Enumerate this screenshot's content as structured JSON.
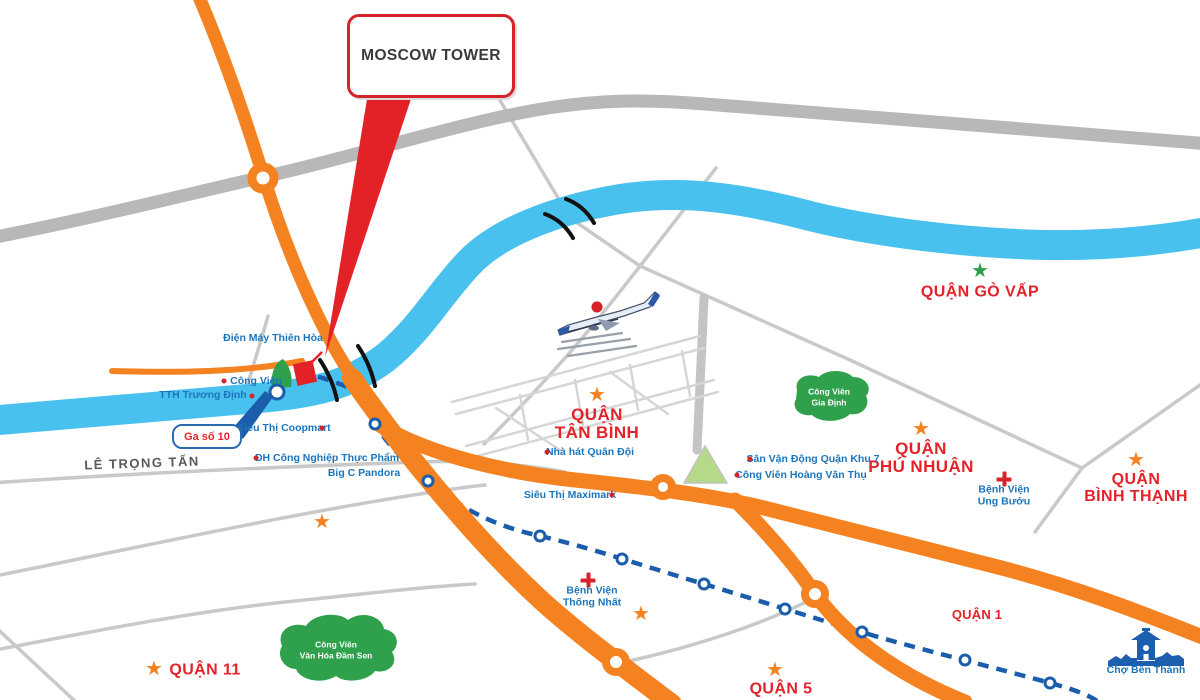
{
  "title_callout": {
    "label": "MOSCOW TOWER"
  },
  "station_callout": {
    "label": "Ga số 10"
  },
  "street": {
    "label": "LÊ TRỌNG TẤN"
  },
  "colors": {
    "road_orange": "#F58220",
    "river_blue": "#49C1EF",
    "metro_blue": "#1A5DAB",
    "label_blue": "#1B75BC",
    "accent_red": "#E4222A",
    "park_green": "#2FA04C",
    "road_gray": "#B8B8B8",
    "star_green": "#2E9E4A"
  },
  "districts": [
    {
      "id": "go-vap",
      "lines": [
        "QUẬN GÒ VẤP"
      ],
      "x": 980,
      "y": 293,
      "font": 16
    },
    {
      "id": "tan-binh",
      "lines": [
        "QUẬN",
        "TÂN BÌNH"
      ],
      "x": 597,
      "y": 424,
      "font": 17
    },
    {
      "id": "phu-nhuan",
      "lines": [
        "QUẬN",
        "PHÚ NHUẬN"
      ],
      "x": 921,
      "y": 458,
      "font": 17
    },
    {
      "id": "binh-thanh",
      "lines": [
        "QUẬN",
        "BÌNH THẠNH"
      ],
      "x": 1136,
      "y": 489,
      "font": 16
    },
    {
      "id": "quan-11",
      "lines": [
        "QUẬN 11"
      ],
      "x": 205,
      "y": 671,
      "font": 16
    },
    {
      "id": "quan-5",
      "lines": [
        "QUẬN 5"
      ],
      "x": 781,
      "y": 690,
      "font": 16
    },
    {
      "id": "quan-1",
      "lines": [
        "QUẬN 1"
      ],
      "x": 977,
      "y": 615,
      "font": 13
    }
  ],
  "landmarks": [
    {
      "id": "dien-may-thien-hoa",
      "lines": [
        "Điện Máy Thiên Hòa"
      ],
      "x": 273,
      "y": 338
    },
    {
      "id": "cong-vien",
      "lines": [
        "Công Viên"
      ],
      "x": 256,
      "y": 381
    },
    {
      "id": "tth-truong-dinh",
      "lines": [
        "TTH Trương Định"
      ],
      "x": 203,
      "y": 395
    },
    {
      "id": "sieu-thi-coopmart",
      "lines": [
        "Siêu Thị Coopmart"
      ],
      "x": 284,
      "y": 428
    },
    {
      "id": "dh-cong-nghiep-thuc-pham",
      "lines": [
        "ĐH Công Nghiệp Thực Phẩm"
      ],
      "x": 327,
      "y": 458
    },
    {
      "id": "big-c-pandora",
      "lines": [
        "Big C Pandora"
      ],
      "x": 364,
      "y": 473
    },
    {
      "id": "sieu-thi-maximark",
      "lines": [
        "Siêu Thị Maximark"
      ],
      "x": 570,
      "y": 495
    },
    {
      "id": "nha-hat-quan-doi",
      "lines": [
        "Nhà hát Quân Đội"
      ],
      "x": 590,
      "y": 452
    },
    {
      "id": "san-van-dong-quan-khu-7",
      "lines": [
        "Sân Vận Động Quận Khu 7"
      ],
      "x": 813,
      "y": 459
    },
    {
      "id": "cong-vien-hoang-van-thu",
      "lines": [
        "Công Viên Hoàng Văn Thụ"
      ],
      "x": 801,
      "y": 475
    },
    {
      "id": "benh-vien-ung-buou",
      "lines": [
        "Bệnh Viện",
        "Ung Bướu"
      ],
      "x": 1004,
      "y": 496
    },
    {
      "id": "benh-vien-thong-nhat",
      "lines": [
        "Bệnh Viện",
        "Thống Nhất"
      ],
      "x": 592,
      "y": 597
    },
    {
      "id": "cho-ben-thanh",
      "lines": [
        "Chợ Bến Thành"
      ],
      "x": 1146,
      "y": 670
    }
  ],
  "parks": [
    {
      "id": "cong-vien-gia-dinh",
      "lines": [
        "Công Viên",
        "Gia Định"
      ],
      "x": 829,
      "y": 397
    },
    {
      "id": "cong-vien-van-hoa-dam-sen",
      "lines": [
        "Công Viên",
        "Văn Hóa Đầm Sen"
      ],
      "x": 336,
      "y": 650
    }
  ],
  "stars": [
    {
      "x": 980,
      "y": 271,
      "color": "#2E9E4A"
    },
    {
      "x": 597,
      "y": 395,
      "color": "#F58220"
    },
    {
      "x": 921,
      "y": 429,
      "color": "#F58220"
    },
    {
      "x": 1136,
      "y": 460,
      "color": "#F58220"
    },
    {
      "x": 154,
      "y": 669,
      "color": "#F58220"
    },
    {
      "x": 775,
      "y": 670,
      "color": "#F58220"
    },
    {
      "x": 322,
      "y": 522,
      "color": "#F58220"
    },
    {
      "x": 641,
      "y": 614,
      "color": "#F58220"
    }
  ],
  "dots": [
    {
      "x": 224,
      "y": 381
    },
    {
      "x": 252,
      "y": 396
    },
    {
      "x": 322,
      "y": 428
    },
    {
      "x": 256,
      "y": 458
    },
    {
      "x": 612,
      "y": 495
    },
    {
      "x": 547,
      "y": 452
    },
    {
      "x": 750,
      "y": 459
    },
    {
      "x": 737,
      "y": 475
    },
    {
      "x": 597,
      "y": 307,
      "s": 11
    }
  ],
  "crosses": [
    {
      "x": 1004,
      "y": 479
    },
    {
      "x": 588,
      "y": 580
    }
  ],
  "metro_stations": [
    {
      "x": 277,
      "y": 392,
      "s": 17
    },
    {
      "x": 375,
      "y": 424
    },
    {
      "x": 428,
      "y": 481
    },
    {
      "x": 540,
      "y": 536
    },
    {
      "x": 622,
      "y": 559
    },
    {
      "x": 704,
      "y": 584
    },
    {
      "x": 785,
      "y": 609
    },
    {
      "x": 862,
      "y": 632
    },
    {
      "x": 965,
      "y": 660
    },
    {
      "x": 1050,
      "y": 683
    }
  ]
}
